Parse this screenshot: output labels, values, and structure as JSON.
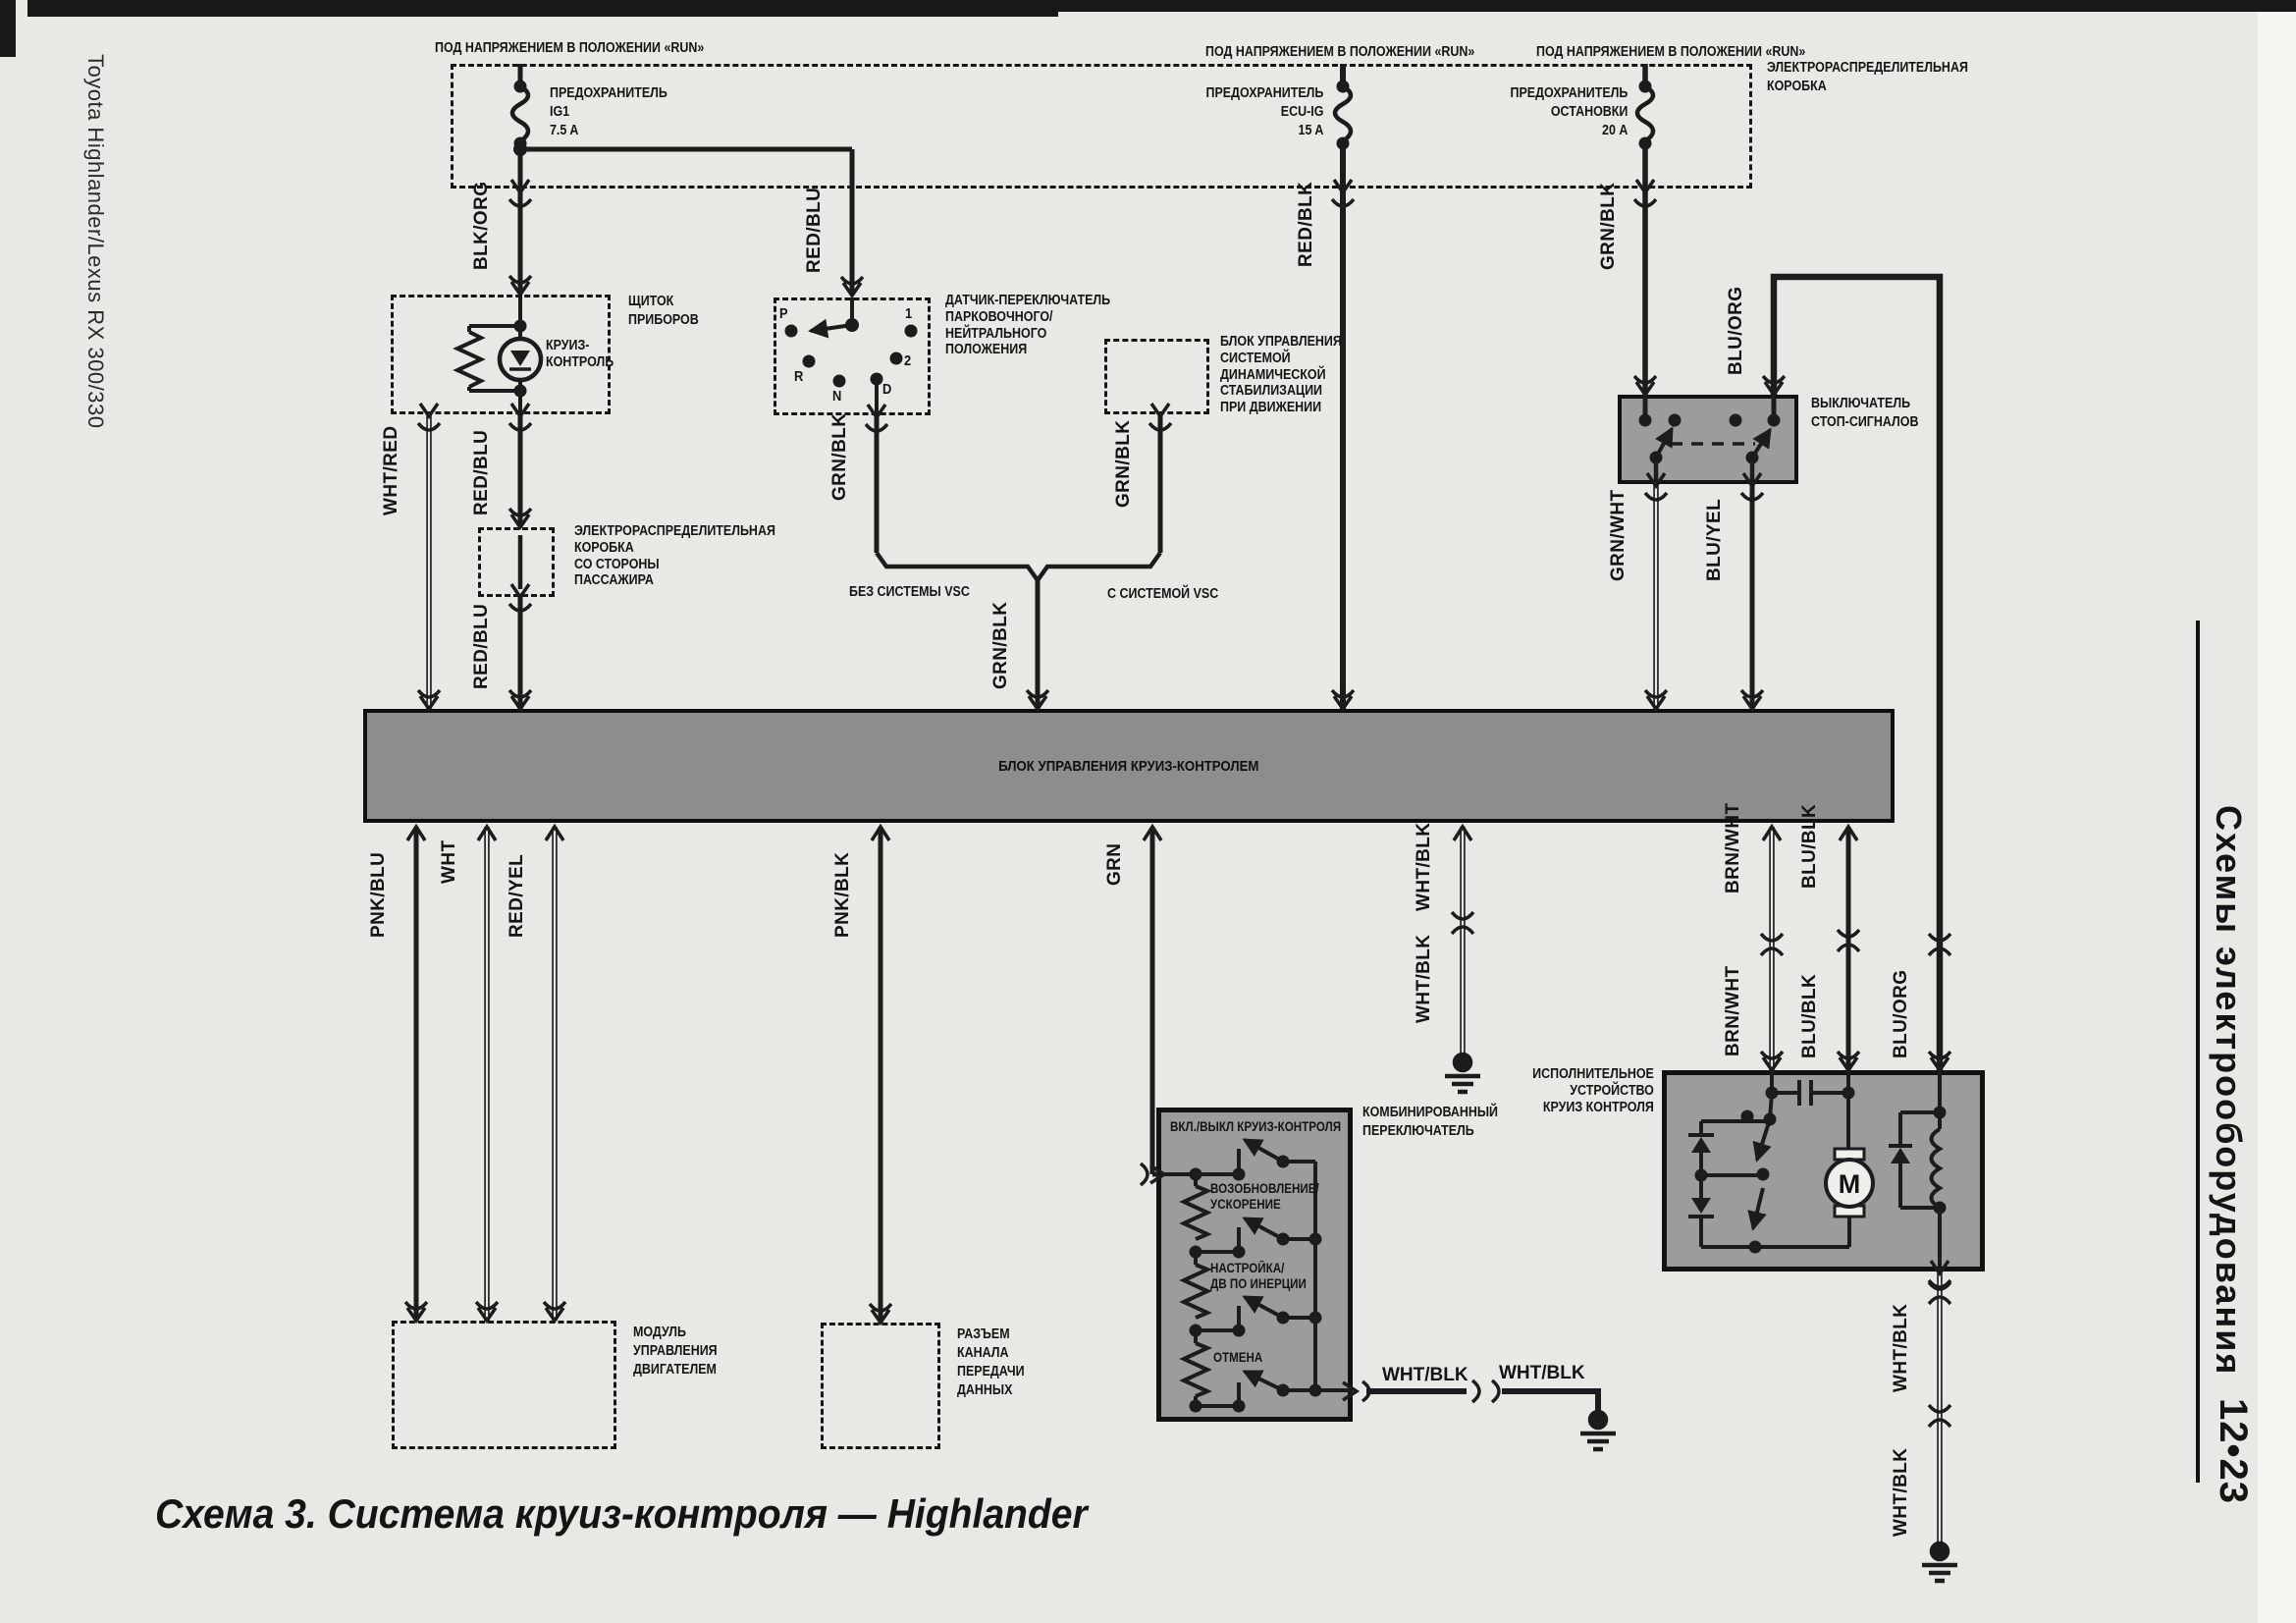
{
  "page": {
    "margin_left": "Toyota Highlander/Lexus RX 300/330",
    "margin_right_title": "Схемы электрооборудования",
    "page_number": "12•23",
    "caption": "Схема 3. Система круиз-контроля — Highlander"
  },
  "power": {
    "run1": "ПОД НАПРЯЖЕНИЕМ В ПОЛОЖЕНИИ «RUN»",
    "run2": "ПОД НАПРЯЖЕНИЕМ В ПОЛОЖЕНИИ «RUN»",
    "run3": "ПОД НАПРЯЖЕНИЕМ В ПОЛОЖЕНИИ «RUN»",
    "junction_box": "ЭЛЕКТРОРАСПРЕДЕЛИТЕЛЬНАЯ\nКОРОБКА",
    "fuse_ig1": "ПРЕДОХРАНИТЕЛЬ\nIG1\n7.5 A",
    "fuse_ecu_ig": "ПРЕДОХРАНИТЕЛЬ\nECU-IG\n15 A",
    "fuse_stop": "ПРЕДОХРАНИТЕЛЬ\nОСТАНОВКИ\n20 A"
  },
  "cluster": {
    "name": "ЩИТОК\nПРИБОРОВ",
    "lamp": "КРУИЗ-\nКОНТРОЛЬ"
  },
  "pnp": {
    "name": "ДАТЧИК-ПЕРЕКЛЮЧАТЕЛЬ\nПАРКОВОЧНОГО/\nНЕЙТРАЛЬНОГО\nПОЛОЖЕНИЯ",
    "p": "P",
    "r": "R",
    "n": "N",
    "d": "D",
    "n1": "1",
    "n2": "2"
  },
  "vsc": {
    "name": "БЛОК УПРАВЛЕНИЯ\nСИСТЕМОЙ\nДИНАМИЧЕСКОЙ\nСТАБИЛИЗАЦИИ\nПРИ ДВИЖЕНИИ",
    "without": "БЕЗ СИСТЕМЫ VSC",
    "with": "С СИСТЕМОЙ VSC"
  },
  "passenger_jb": "ЭЛЕКТРОРАСПРЕДЕЛИТЕЛЬНАЯ\nКОРОБКА\nСО СТОРОНЫ\nПАССАЖИРА",
  "stop_switch": "ВЫКЛЮЧАТЕЛЬ\nСТОП-СИГНАЛОВ",
  "cruise_ecu": "БЛОК УПРАВЛЕНИЯ КРУИЗ-КОНТРОЛЕМ",
  "engine_module": "МОДУЛЬ\nУПРАВЛЕНИЯ\nДВИГАТЕЛЕМ",
  "dlc": "РАЗЪЕМ\nКАНАЛА\nПЕРЕДАЧИ\nДАННЫХ",
  "combo": {
    "name": "КОМБИНИРОВАННЫЙ\nПЕРЕКЛЮЧАТЕЛЬ",
    "on_off": "ВКЛ./ВЫКЛ КРУИЗ-КОНТРОЛЯ",
    "resume": "ВОЗОБНОВЛЕНИЕ/\nУСКОРЕНИЕ",
    "set": "НАСТРОЙКА/\nДВ ПО ИНЕРЦИИ",
    "cancel": "ОТМЕНА"
  },
  "actuator": {
    "name": "ИСПОЛНИТЕЛЬНОЕ\nУСТРОЙСТВО\nКРУИЗ КОНТРОЛЯ",
    "motor": "M"
  },
  "wires": {
    "blk_org": "BLK/ORG",
    "red_blu_a": "RED/BLU",
    "wht_red": "WHT/RED",
    "red_blu_b": "RED/BLU",
    "red_blu_c": "RED/BLU",
    "grn_blk_a": "GRN/BLK",
    "grn_blk_b": "GRN/BLK",
    "grn_blk_c": "GRN/BLK",
    "grn_blk_d": "GRN/BLK",
    "red_blk": "RED/BLK",
    "blu_org_a": "BLU/ORG",
    "grn_wht": "GRN/WHT",
    "blu_yel": "BLU/YEL",
    "pnk_blu": "PNK/BLU",
    "wht": "WHT",
    "red_yel": "RED/YEL",
    "pnk_blk": "PNK/BLK",
    "grn": "GRN",
    "wht_blk_a": "WHT/BLK",
    "wht_blk_b": "WHT/BLK",
    "brn_wht_a": "BRN/WHT",
    "blu_blk_a": "BLU/BLK",
    "brn_wht_b": "BRN/WHT",
    "blu_blk_b": "BLU/BLK",
    "blu_org_b": "BLU/ORG",
    "wht_blk_h1": "WHT/BLK",
    "wht_blk_h2": "WHT/BLK",
    "wht_blk_c": "WHT/BLK",
    "wht_blk_d": "WHT/BLK"
  }
}
